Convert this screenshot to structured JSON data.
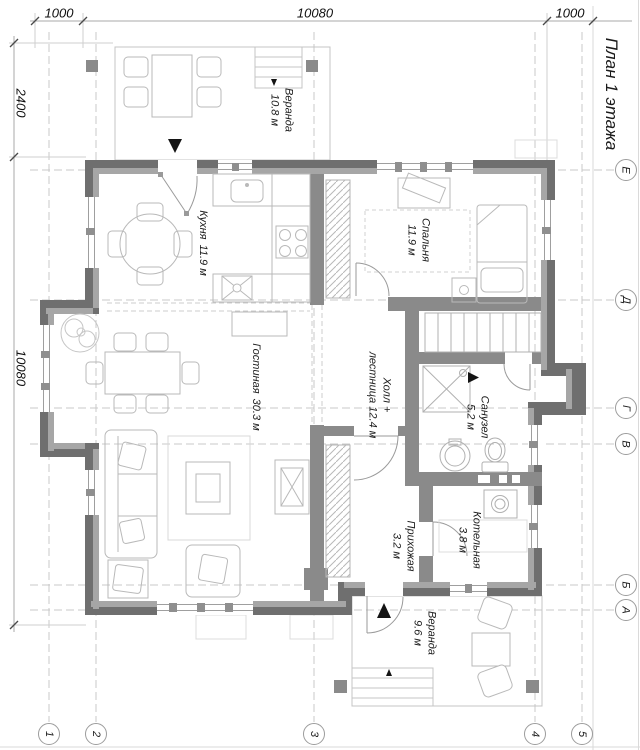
{
  "drawing_title": "План 1 этажа",
  "dimensions": {
    "top": [
      "1000",
      "10080",
      "1000"
    ],
    "left": [
      "2400",
      "10080"
    ]
  },
  "axes": {
    "bottom": [
      "1",
      "2",
      "3",
      "4",
      "5"
    ],
    "right": [
      "Е",
      "Д",
      "Г",
      "В",
      "Б",
      "А"
    ]
  },
  "rooms": {
    "veranda_top": {
      "name": "Веранда",
      "area": "10.8 м"
    },
    "kitchen": {
      "name": "Кухня",
      "area": "11.9 м"
    },
    "bedroom": {
      "name": "Спальня",
      "area": "11.9 м"
    },
    "hall": {
      "name": "Холл +",
      "area": "лестница 12.4 м"
    },
    "living": {
      "name": "Гостиная",
      "area": "30.3 м"
    },
    "bathroom": {
      "name": "Санузел",
      "area": "5.2 м"
    },
    "boiler": {
      "name": "Котельная",
      "area": "3.8 м"
    },
    "entry": {
      "name": "Прихожая",
      "area": "3.2 м"
    },
    "veranda_bottom": {
      "name": "Веранда",
      "area": "9.6 м"
    }
  },
  "colors": {
    "wall_outer": "#6f6f6f",
    "wall_inner": "#a6a6a6",
    "wall_interior": "#8a8a8a",
    "furniture_line": "#b9b9b9",
    "grid_line": "#c9c9c9",
    "text": "#1c1c1c"
  }
}
